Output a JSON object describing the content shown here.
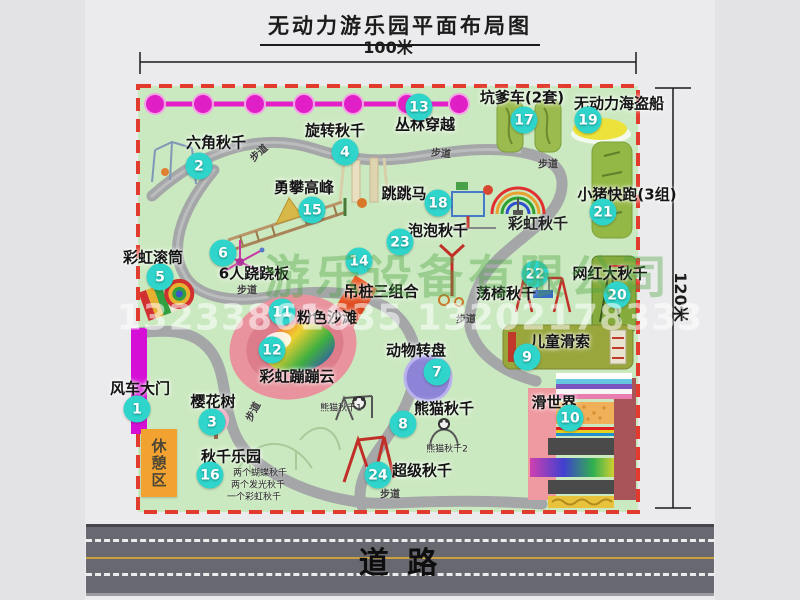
{
  "title": "无动力游乐园平面布局图",
  "dimensions": {
    "width_label": "100米",
    "height_label": "120米"
  },
  "road": {
    "label": "道   路"
  },
  "rest_area_label": "休憩区",
  "watermarks": {
    "company": "游乐设备有限公司",
    "phone": "13233861635 13202178333"
  },
  "colors": {
    "park_green": "#cbe9c0",
    "boundary_red": "#e23b2e",
    "badge_teal": "#2fd4ca",
    "jungle_line_magenta": "#e41fc8",
    "gate_magenta": "#d60fd6",
    "rest_area_orange": "#f2a230",
    "path_gray": "#a4a6a8",
    "road_gray": "#686870"
  },
  "path_label_text": "步道",
  "path_labels": [
    {
      "x": 258,
      "y": 152,
      "rot": -42
    },
    {
      "x": 441,
      "y": 152,
      "rot": 5
    },
    {
      "x": 548,
      "y": 163,
      "rot": 0
    },
    {
      "x": 247,
      "y": 289,
      "rot": 0
    },
    {
      "x": 466,
      "y": 318,
      "rot": 0
    },
    {
      "x": 252,
      "y": 411,
      "rot": -62
    },
    {
      "x": 390,
      "y": 493,
      "rot": 0
    }
  ],
  "items": [
    {
      "num": "1",
      "label": "风车大门",
      "cx": 137,
      "cy": 409,
      "lx": 140,
      "ly": 388
    },
    {
      "num": "2",
      "label": "六角秋千",
      "cx": 199,
      "cy": 166,
      "lx": 216,
      "ly": 142
    },
    {
      "num": "3",
      "label": "樱花树",
      "cx": 212,
      "cy": 422,
      "lx": 213,
      "ly": 401
    },
    {
      "num": "4",
      "label": "旋转秋千",
      "cx": 345,
      "cy": 152,
      "lx": 335,
      "ly": 130
    },
    {
      "num": "5",
      "label": "彩虹滚筒",
      "cx": 160,
      "cy": 277,
      "lx": 153,
      "ly": 257
    },
    {
      "num": "6",
      "label": "6人跷跷板",
      "cx": 223,
      "cy": 253,
      "lx": 254,
      "ly": 273
    },
    {
      "num": "7",
      "label": "动物转盘",
      "cx": 437,
      "cy": 372,
      "lx": 416,
      "ly": 350
    },
    {
      "num": "8",
      "label": "熊猫秋千",
      "cx": 403,
      "cy": 424,
      "lx": 444,
      "ly": 408
    },
    {
      "num": "9",
      "label": "儿童滑索",
      "cx": 527,
      "cy": 357,
      "lx": 560,
      "ly": 341
    },
    {
      "num": "10",
      "label": "滑世界",
      "cx": 570,
      "cy": 418,
      "lx": 554,
      "ly": 402
    },
    {
      "num": "11",
      "label": "粉色沙滩",
      "cx": 282,
      "cy": 312,
      "lx": 327,
      "ly": 317
    },
    {
      "num": "12",
      "label": "彩虹蹦蹦云",
      "cx": 272,
      "cy": 350,
      "lx": 297,
      "ly": 376
    },
    {
      "num": "13",
      "label": "丛林穿越",
      "cx": 419,
      "cy": 107,
      "lx": 425,
      "ly": 124
    },
    {
      "num": "14",
      "label": "吊桩三组合",
      "cx": 359,
      "cy": 261,
      "lx": 381,
      "ly": 291
    },
    {
      "num": "15",
      "label": "勇攀高峰",
      "cx": 312,
      "cy": 210,
      "lx": 304,
      "ly": 187
    },
    {
      "num": "16",
      "label": "秋千乐园",
      "cx": 210,
      "cy": 475,
      "lx": 231,
      "ly": 456
    },
    {
      "num": "17",
      "label": "坑爹车(2套)",
      "cx": 524,
      "cy": 120,
      "lx": 522,
      "ly": 97
    },
    {
      "num": "18",
      "label": "跳跳马",
      "cx": 438,
      "cy": 203,
      "lx": 404,
      "ly": 193
    },
    {
      "num": "19",
      "label": "无动力海盗船",
      "cx": 588,
      "cy": 120,
      "lx": 619,
      "ly": 103
    },
    {
      "num": "20",
      "label": "网红大秋千",
      "cx": 617,
      "cy": 295,
      "lx": 610,
      "ly": 273
    },
    {
      "num": "21",
      "label": "小猪快跑(3组)",
      "cx": 603,
      "cy": 212,
      "lx": 627,
      "ly": 194
    },
    {
      "num": "22",
      "label": "荡椅秋千",
      "cx": 535,
      "cy": 274,
      "lx": 506,
      "ly": 293
    },
    {
      "num": "23",
      "label": "泡泡秋千",
      "cx": 400,
      "cy": 242,
      "lx": 438,
      "ly": 230
    },
    {
      "num": "24",
      "label": "超级秋千",
      "cx": 378,
      "cy": 475,
      "lx": 422,
      "ly": 470
    }
  ],
  "annotations": [
    {
      "text": "彩虹秋千",
      "x": 538,
      "y": 223,
      "size": 15,
      "bold": true
    },
    {
      "text": "熊猫秋千1",
      "x": 341,
      "y": 407,
      "size": 9,
      "bold": false
    },
    {
      "text": "熊猫秋千2",
      "x": 447,
      "y": 448,
      "size": 9,
      "bold": false
    },
    {
      "text": "两个蝴蝶秋千",
      "x": 260,
      "y": 472,
      "size": 9,
      "bold": false
    },
    {
      "text": "两个发光秋千",
      "x": 258,
      "y": 484,
      "size": 9,
      "bold": false
    },
    {
      "text": "一个彩虹秋千",
      "x": 254,
      "y": 496,
      "size": 9,
      "bold": false
    }
  ]
}
